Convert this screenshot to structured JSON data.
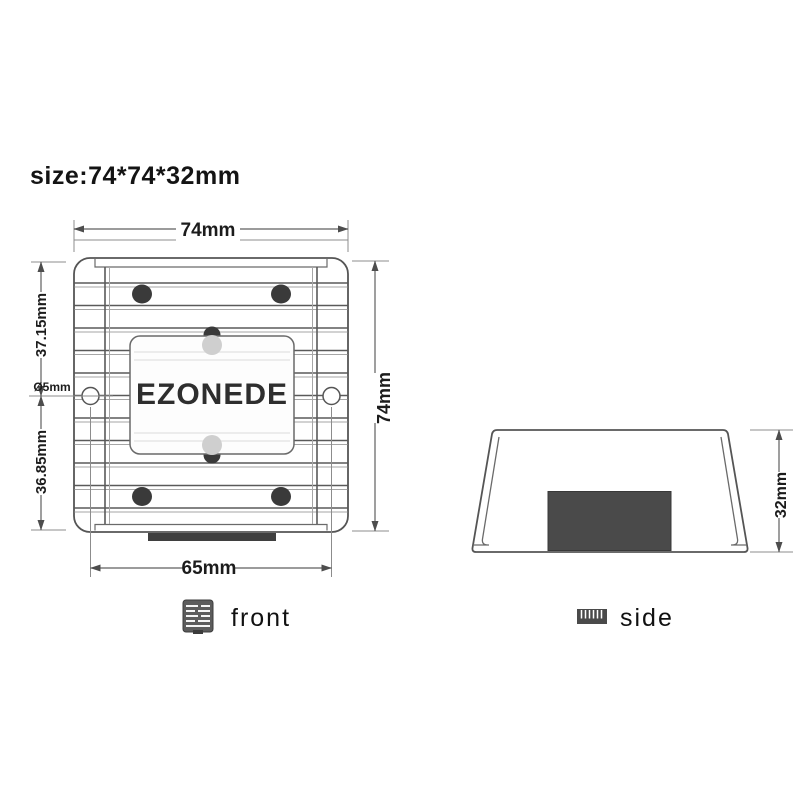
{
  "header": {
    "size_label": "size:74*74*32mm"
  },
  "front_view": {
    "brand": "EZONEDE",
    "dimensions": {
      "overall_width": "74mm",
      "overall_height": "74mm",
      "upper_section_height": "37.15mm",
      "lower_section_height": "36.85mm",
      "mounting_hole_diameter": "Ø5mm",
      "mounting_hole_spacing": "65mm"
    }
  },
  "side_view": {
    "dimensions": {
      "overall_height": "32mm"
    }
  },
  "captions": {
    "front": {
      "label": "front",
      "icon": "front-view-thumbnail-icon"
    },
    "side": {
      "label": "side",
      "icon": "side-view-thumbnail-icon"
    }
  },
  "colors": {
    "background": "#ffffff",
    "line": "#555555",
    "text": "#1c1c1c",
    "screw_fill": "#3a3a3a",
    "connector_fill": "#4a4a4a",
    "label_tab_dark": "#3a3a3a",
    "label_tab_light": "#cfcfcf"
  }
}
